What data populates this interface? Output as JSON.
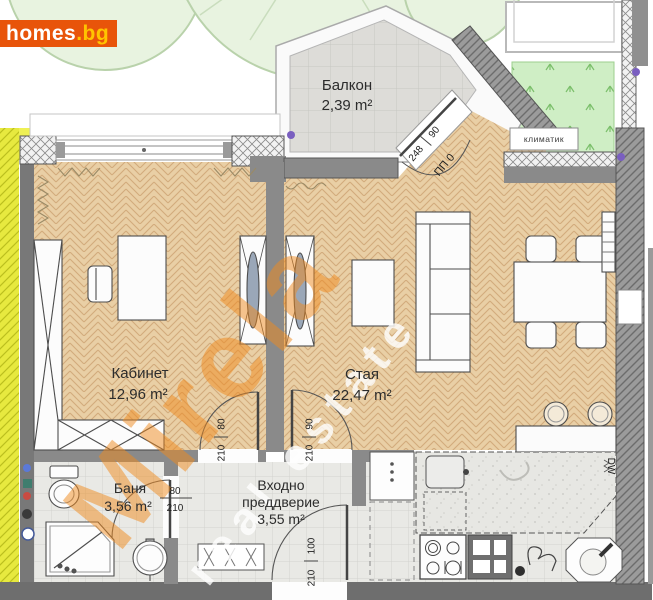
{
  "logo": {
    "brand": "homes",
    "tld": ".bg"
  },
  "watermark": {
    "brand": "Mirela",
    "tagline": "real estate"
  },
  "rooms": {
    "balcony": {
      "name": "Балкон",
      "area": "2,39 m²"
    },
    "office": {
      "name": "Кабинет",
      "area": "12,96 m²"
    },
    "living": {
      "name": "Стая",
      "area": "22,47 m²"
    },
    "bathroom": {
      "name": "Баня",
      "area": "3,56 m²"
    },
    "hall": {
      "line1": "Входно",
      "line2": "преддверие",
      "area": "3,55 m²"
    }
  },
  "labels": {
    "ac": "климатик",
    "dw": "DW"
  },
  "dims": {
    "office": {
      "w": "80",
      "h": "210"
    },
    "living": {
      "w": "90",
      "h": "210"
    },
    "entry": {
      "w": "100",
      "h": "210"
    },
    "bath": {
      "w": "80",
      "h": "210"
    },
    "balcony": {
      "w": "90",
      "h": "248"
    },
    "balcony_code": "ПП 0"
  },
  "colors": {
    "logo_bg": "#e8540a",
    "logo_tld": "#ffc400",
    "watermark_orange": "#f08a1e",
    "wood_floor": "#e9cfa5",
    "tile_floor": "#e9e9e5",
    "wall_gray": "#8a8a8a",
    "grass_green": "#cfeec5",
    "yellow_strip": "#e7e93f",
    "marker_purple": "#7a5fc0"
  }
}
